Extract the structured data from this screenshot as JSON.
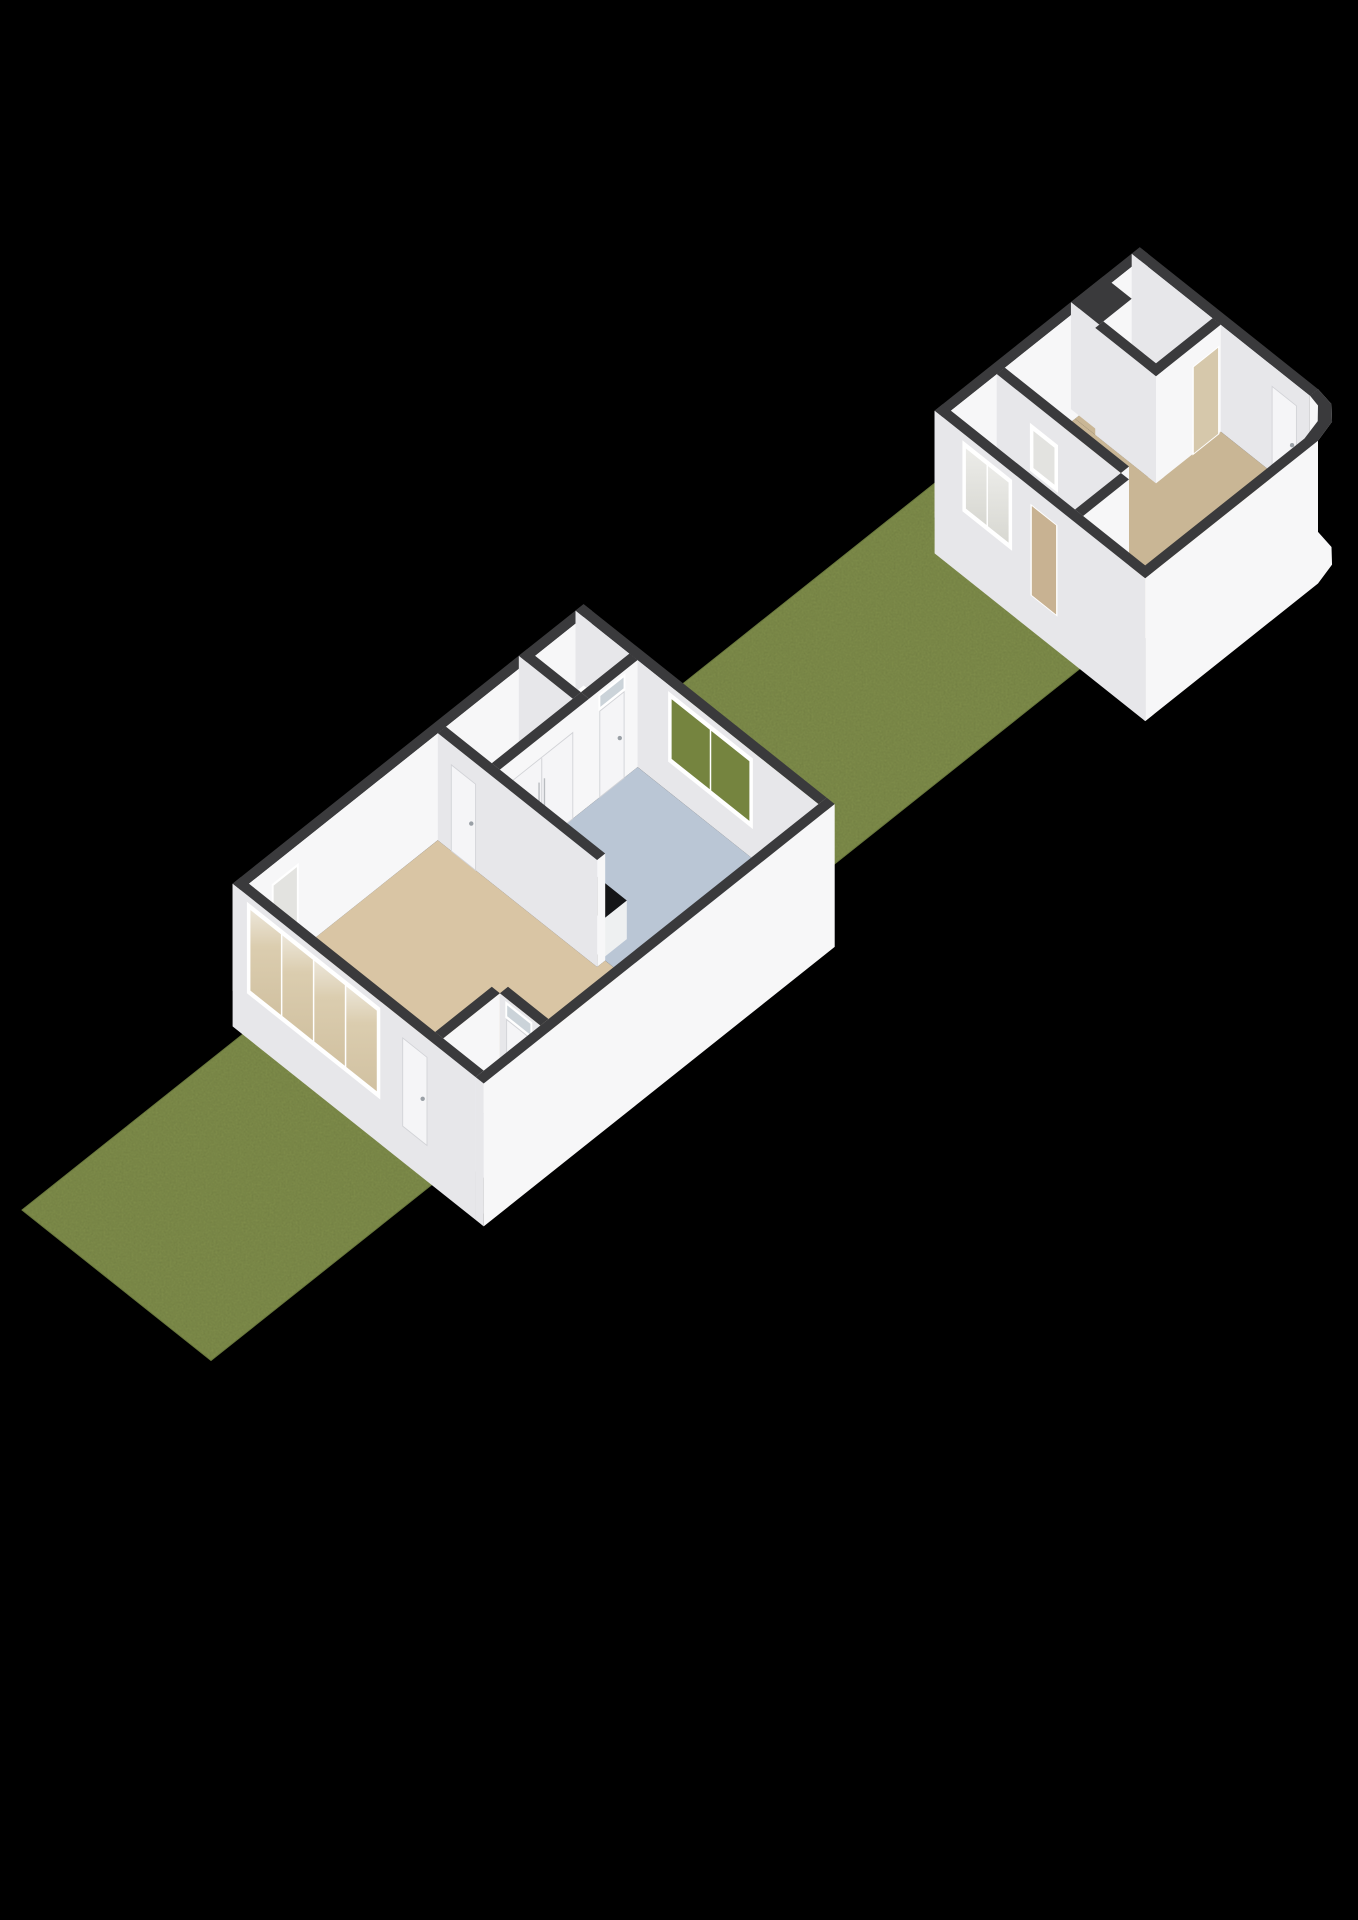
{
  "scene": {
    "type": "3d-floorplan-render",
    "canvas": {
      "width": 1358,
      "height": 1920,
      "background": "#000000"
    },
    "projection": {
      "ux": 27,
      "uy": 21.5,
      "hs": 42,
      "x0": 22,
      "y0": 1210,
      "wall_h": 2.55,
      "plinth": -0.85
    },
    "palette": {
      "grass": "#7e8c4a",
      "grassEdge": "#6b7a3e",
      "grassSpeck": "#222b10",
      "wallTop": "#3a3a3c",
      "faceMU": "#e7e7ea",
      "facePV": "#f7f7f8",
      "floorLiving": "#d9c5a4",
      "floorKitchen": "#bac6d5",
      "floorPale": "#ebebe9",
      "floorShed": "#c9b695",
      "counterTop": "#141517",
      "counterMU": "#dfe0e2",
      "counterPV": "#eef0f1",
      "sofaMU": "#e9eaec",
      "sofaPV": "#f4f4f6",
      "sofaTop": "#fbfbfd",
      "doorLeaf": "#f5f5f7",
      "doorEdge": "#d2d3d7",
      "handle": "#9aa0a6",
      "frame": "#ffffff",
      "glassGreen": "#75843f",
      "glassPale": "#e3e3e0",
      "glassSky": "#cbd3d9",
      "throughTan": "#c9b593",
      "throughShed": "#c8b292",
      "throughRoom": "#d6c8ab",
      "fixture": "#fcfcfd",
      "fixtureEdge": "#c9c9cd",
      "trayInner": "#3a3b3e"
    },
    "elements": [
      {
        "t": "grass",
        "n": "front-yard-grass",
        "pts": [
          [
            0,
            0
          ],
          [
            9,
            0
          ],
          [
            9,
            7
          ],
          [
            0,
            7
          ]
        ]
      },
      {
        "t": "grass",
        "n": "middle-yard-grass",
        "pts": [
          [
            22,
            0
          ],
          [
            41.4,
            0
          ],
          [
            41.4,
            0.8
          ],
          [
            33,
            0.8
          ],
          [
            33,
            7
          ],
          [
            22,
            7
          ]
        ]
      },
      {
        "t": "floor",
        "n": "living-room-floor",
        "f": "floorLiving",
        "pts": [
          [
            9.3,
            -0.9
          ],
          [
            16.3,
            -0.9
          ],
          [
            16.3,
            5.0
          ],
          [
            16.6,
            5.0
          ],
          [
            16.6,
            7.8
          ],
          [
            11.7,
            7.8
          ],
          [
            11.7,
            6.3
          ],
          [
            11.4,
            6.3
          ],
          [
            11.4,
            6.0
          ],
          [
            9.3,
            6.0
          ]
        ]
      },
      {
        "t": "floor",
        "n": "shower-room-floor",
        "f": "floorPale",
        "pts": [
          [
            9.3,
            6.3
          ],
          [
            11.4,
            6.3
          ],
          [
            11.4,
            7.8
          ],
          [
            9.3,
            7.8
          ]
        ]
      },
      {
        "t": "floor",
        "n": "kitchen-floor",
        "f": "floorKitchen",
        "pts": [
          [
            16.6,
            1.1
          ],
          [
            21.7,
            1.1
          ],
          [
            21.7,
            7.8
          ],
          [
            16.6,
            7.8
          ]
        ]
      },
      {
        "t": "floor",
        "n": "back-hall-floor",
        "f": "floorPale",
        "pts": [
          [
            16.6,
            -0.9
          ],
          [
            19.6,
            -0.9
          ],
          [
            19.6,
            0.8
          ],
          [
            16.6,
            0.8
          ]
        ]
      },
      {
        "t": "floor",
        "n": "toilet-room-floor",
        "f": "floorPale",
        "pts": [
          [
            19.9,
            -0.9
          ],
          [
            21.7,
            -0.9
          ],
          [
            21.7,
            0.8
          ],
          [
            19.9,
            0.8
          ]
        ]
      },
      {
        "t": "tray",
        "n": "shower-tray",
        "u1": 10.8,
        "v1": 6.45,
        "u2": 11.35,
        "v2": 7.15
      },
      {
        "t": "box",
        "n": "house-nw-wall",
        "u1": 9,
        "v1": -1.2,
        "u2": 22,
        "v2": -0.9,
        "op": [
          {
            "f": "pv",
            "k": "glass",
            "a1": 10.2,
            "a2": 11.1,
            "b1": 0,
            "b2": 2.05,
            "g": "glassPale"
          }
        ]
      },
      {
        "t": "box",
        "n": "house-ne-wall",
        "u1": 21.7,
        "v1": -1.2,
        "u2": 22,
        "v2": 7.8,
        "op": [
          {
            "f": "mu",
            "k": "window",
            "a1": 2.3,
            "a2": 5.3,
            "b1": 0.78,
            "b2": 2.32,
            "m": 1,
            "g": "glassGreen"
          }
        ]
      },
      {
        "t": "toilet",
        "n": "toilet-fixtures",
        "cistern": [
          21.42,
          -0.5,
          21.7,
          0.1,
          0,
          0.78
        ],
        "bowl": [
          21.14,
          -0.2
        ],
        "corner_sink": [
          21.5,
          -0.9,
          21.7,
          -0.66,
          0.72,
          0.92
        ]
      },
      {
        "t": "box",
        "n": "toilet-sw-wall",
        "u1": 19.6,
        "v1": -1.2,
        "u2": 19.9,
        "v2": 0.8
      },
      {
        "t": "box",
        "n": "toilet-se-wall",
        "u1": 19.9,
        "v1": 0.8,
        "u2": 21.7,
        "v2": 1.1,
        "op": [
          {
            "f": "pv",
            "k": "door",
            "a1": 20.3,
            "a2": 21.2,
            "b1": 0,
            "b2": 2.05
          },
          {
            "f": "pv",
            "k": "glass",
            "a1": 20.3,
            "a2": 21.2,
            "b1": 2.12,
            "b2": 2.42,
            "g": "glassSky"
          }
        ]
      },
      {
        "t": "box",
        "n": "kitchen-closet-wall",
        "u1": 16.6,
        "v1": 0.8,
        "u2": 19.9,
        "v2": 1.1,
        "op": [
          {
            "f": "pv",
            "k": "closet",
            "a1": 17.0,
            "a2": 19.3,
            "b1": 0,
            "b2": 2.05
          }
        ]
      },
      {
        "t": "box",
        "n": "kitchen-counter",
        "u1": 16.6,
        "v1": 1.4,
        "u2": 17.5,
        "v2": 4.9,
        "h2": 0.92,
        "fmu": "counterMU",
        "fpv": "counterPV",
        "ftop": "counterTop"
      },
      {
        "t": "sink",
        "n": "kitchen-sink",
        "u": 17.05,
        "v": 1.95,
        "h": 0.92
      },
      {
        "t": "box",
        "n": "white-lounge-unit",
        "u1": 20.2,
        "v1": 7.0,
        "u2": 21.6,
        "v2": 7.8,
        "h2": 0.72,
        "fmu": "sofaMU",
        "fpv": "sofaPV",
        "ftop": "sofaTop"
      },
      {
        "t": "box",
        "n": "living-divider-wall",
        "u1": 16.3,
        "v1": -0.9,
        "u2": 16.6,
        "v2": 5.0,
        "op": [
          {
            "f": "mu",
            "k": "door",
            "a1": -0.4,
            "a2": 0.5,
            "b1": 0,
            "b2": 2.05
          }
        ]
      },
      {
        "t": "box",
        "n": "shower-nw-wall",
        "u1": 9.3,
        "v1": 6.0,
        "u2": 11.4,
        "v2": 6.3
      },
      {
        "t": "box",
        "n": "shower-ne-wall",
        "u1": 11.4,
        "v1": 6.3,
        "u2": 11.7,
        "v2": 7.8,
        "op": [
          {
            "f": "mu",
            "k": "door",
            "a1": 6.55,
            "a2": 7.45,
            "b1": 0,
            "b2": 2.05
          },
          {
            "f": "mu",
            "k": "glass",
            "a1": 6.55,
            "a2": 7.45,
            "b1": 2.12,
            "b2": 2.42,
            "g": "glassSky"
          }
        ]
      },
      {
        "t": "box",
        "n": "front-facade",
        "u1": 9,
        "v1": -1.2,
        "u2": 9.3,
        "v2": 7.8,
        "base": -0.85,
        "op": [
          {
            "f": "mu",
            "k": "window",
            "a1": -0.6,
            "a2": 4.2,
            "b1": 0.28,
            "b2": 2.32,
            "m": 3,
            "g": "gTan"
          },
          {
            "f": "mu",
            "k": "door",
            "a1": 5.1,
            "a2": 6.0,
            "b1": 0,
            "b2": 2.1
          }
        ]
      },
      {
        "t": "box",
        "n": "house-se-wall",
        "u1": 9,
        "v1": 7.8,
        "u2": 22,
        "v2": 8.1,
        "base": -0.85
      },
      {
        "t": "floor",
        "n": "shed-hall-floor",
        "f": "floorShed",
        "pts": [
          [
            33.3,
            1.1
          ],
          [
            35.0,
            1.1
          ],
          [
            35.0,
            5.7
          ],
          [
            33.3,
            5.7
          ]
        ]
      },
      {
        "t": "floor",
        "n": "shed-storage-floor",
        "f": "floorShed",
        "pts": [
          [
            37.9,
            1.1
          ],
          [
            40.3,
            1.1
          ],
          [
            40.3,
            3.8
          ],
          [
            37.9,
            3.8
          ]
        ]
      },
      {
        "t": "floor",
        "n": "shed-main-room-floor",
        "f": "floorShed",
        "pts": [
          [
            35.0,
            1.1
          ],
          [
            37.9,
            1.1
          ],
          [
            37.9,
            3.8
          ],
          [
            40.3,
            3.8
          ],
          [
            40.3,
            6.9
          ],
          [
            39.6,
            7.5
          ],
          [
            33.3,
            7.5
          ],
          [
            33.3,
            6.0
          ],
          [
            35.0,
            6.0
          ]
        ]
      },
      {
        "t": "box",
        "n": "shed-nw-wall",
        "u1": 33,
        "v1": 0.8,
        "u2": 40.6,
        "v2": 1.1
      },
      {
        "t": "box",
        "n": "shed-notch-block",
        "u1": 38.05,
        "v1": 0.8,
        "u2": 39.25,
        "v2": 1.85
      },
      {
        "t": "box",
        "n": "shed-ne-wall",
        "u1": 40.3,
        "v1": 0.8,
        "u2": 40.6,
        "v2": 7.4,
        "op": [
          {
            "f": "mu",
            "k": "door",
            "a1": 6.0,
            "a2": 6.9,
            "b1": 0,
            "b2": 2.05
          }
        ]
      },
      {
        "t": "box",
        "n": "shed-storage-sw-wall",
        "u1": 37.9,
        "v1": 1.85,
        "u2": 38.2,
        "v2": 4.1
      },
      {
        "t": "box",
        "n": "shed-storage-se-wall",
        "u1": 37.9,
        "v1": 3.8,
        "u2": 40.3,
        "v2": 4.1,
        "op": [
          {
            "f": "pv",
            "k": "pass",
            "a1": 39.3,
            "a2": 40.2,
            "b1": 0,
            "b2": 2.05,
            "fill": "throughRoom"
          }
        ]
      },
      {
        "t": "box",
        "n": "shed-hall-wall",
        "u1": 35.0,
        "v1": 1.1,
        "u2": 35.3,
        "v2": 5.7,
        "op": [
          {
            "f": "mu",
            "k": "window",
            "a1": 2.4,
            "a2": 3.3,
            "b1": 0.95,
            "b2": 1.95,
            "m": 0,
            "g": "glassPale"
          }
        ]
      },
      {
        "t": "box",
        "n": "shed-hall-end-wall",
        "u1": 33.3,
        "v1": 5.7,
        "u2": 35.0,
        "v2": 6.0
      },
      {
        "t": "box",
        "n": "shed-sw-facade",
        "u1": 33,
        "v1": 0.8,
        "u2": 33.3,
        "v2": 8.6,
        "base": -0.85,
        "op": [
          {
            "f": "mu",
            "k": "window",
            "a1": 1.9,
            "a2": 3.6,
            "b1": 0.75,
            "b2": 2.3,
            "m": 1,
            "g": "gPale"
          },
          {
            "f": "mu",
            "k": "pass",
            "a1": 4.4,
            "a2": 5.3,
            "b1": 0,
            "b2": 2.12,
            "fill": "throughShed"
          }
        ]
      },
      {
        "t": "curve",
        "n": "shed-se-curved-wall",
        "base": -0.85,
        "outer": [
          [
            33,
            8.6
          ],
          [
            39.4,
            8.6
          ],
          [
            40.1,
            8.42
          ],
          [
            40.5,
            8.0
          ],
          [
            40.6,
            7.4
          ]
        ],
        "inner": [
          [
            33.3,
            8.3
          ],
          [
            39.2,
            8.3
          ],
          [
            39.85,
            8.14
          ],
          [
            40.22,
            7.78
          ],
          [
            40.3,
            7.4
          ]
        ]
      }
    ]
  }
}
